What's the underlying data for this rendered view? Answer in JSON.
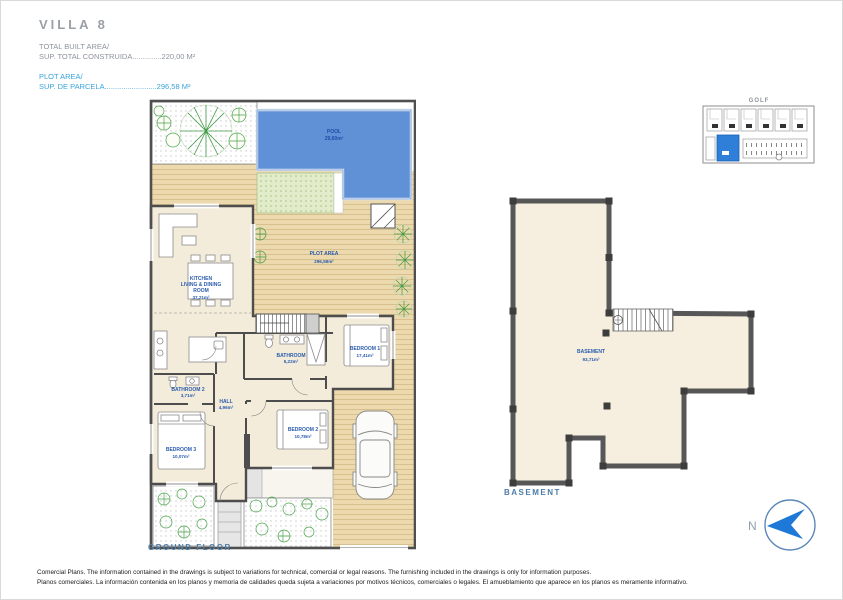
{
  "header": {
    "title": "VILLA 8",
    "built_area_label": "TOTAL BUILT AREA/",
    "built_area_line": "SUP. TOTAL CONSTRUIDA..............220,00 M²",
    "plot_area_label": "PLOT AREA/",
    "plot_area_line": "SUP. DE PARCELA.........................296,58 M²"
  },
  "site_map": {
    "label": "GOLF"
  },
  "rooms": {
    "pool": {
      "l1": "POOL",
      "area": "29,60m²"
    },
    "plot": {
      "l1": "PLOT AREA",
      "area": "296,58m²"
    },
    "kitchen": {
      "l1": "KITCHEN",
      "l2": "LIVING & DINING",
      "l3": "ROOM",
      "area": "37,21m²"
    },
    "bathroom1": {
      "l1": "BATHROOM",
      "area": "5,22m²"
    },
    "bathroom2": {
      "l1": "BATHROOM 2",
      "area": "3,71m²"
    },
    "hall": {
      "l1": "HALL",
      "area": "4,96m²"
    },
    "bedroom1": {
      "l1": "BEDROOM 1",
      "area": "17,41m²"
    },
    "bedroom2": {
      "l1": "BEDROOM 2",
      "area": "10,78m²"
    },
    "bedroom3": {
      "l1": "BEDROOM 3",
      "area": "10,07m²"
    },
    "basement": {
      "l1": "BASEMENT",
      "area": "93,71m²"
    }
  },
  "captions": {
    "ground_floor": "GROUND FLOOR",
    "basement": "BASEMENT"
  },
  "compass": {
    "label": "N"
  },
  "footer": {
    "line1": "Comercial Plans. The information contained in the drawings is subject to variations for technical, comercial or legal reasons. The furnishing included in the drawings is only for information purposes.",
    "line2": "Planos comerciales. La información contenida en los planos y memoria de calidades queda sujeta a variaciones por motivos técnicos, comerciales o legales. El amueblamiento que aparece en los planos es meramente informativo."
  },
  "colors": {
    "pool": "#6090d5",
    "deck": "#ecd9ad",
    "room_fill": "#f4ecdb",
    "wall": "#4d4d4d",
    "label_blue": "#2a5cad",
    "highlight_unit": "#2f7ed8",
    "header_blue": "#3aa3da",
    "compass_blue": "#1e78d8"
  }
}
